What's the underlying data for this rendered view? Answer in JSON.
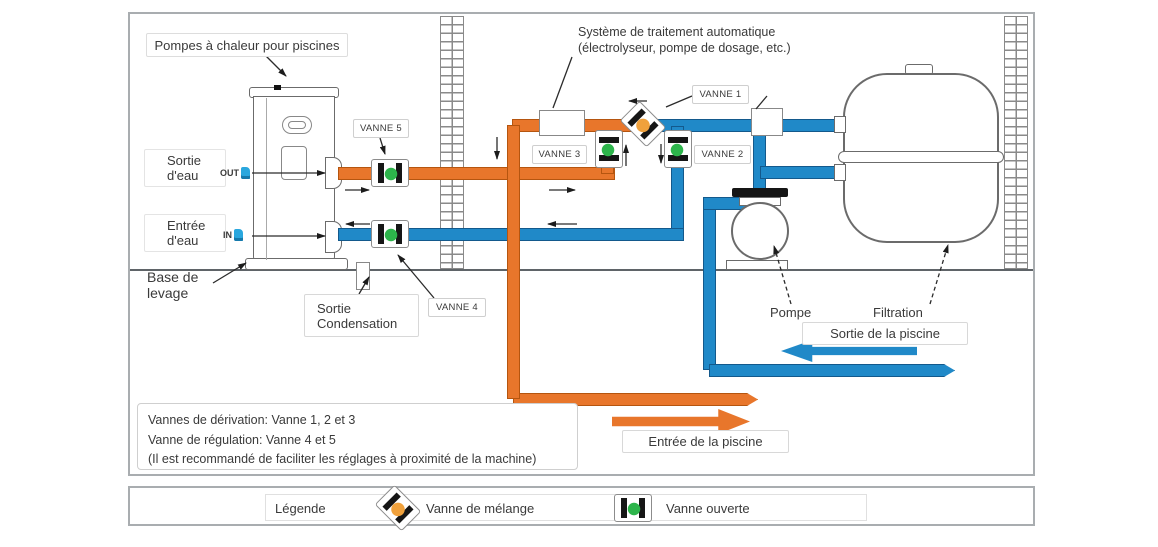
{
  "diagram": {
    "heat_pump_label": "Pompes à chaleur pour piscines",
    "treatment_system": {
      "line1": "Système de traitement automatique",
      "line2": "(électrolyseur, pompe de dosage, etc.)"
    },
    "valves": {
      "v1": "VANNE 1",
      "v2": "VANNE 2",
      "v3": "VANNE 3",
      "v4": "VANNE 4",
      "v5": "VANNE 5"
    },
    "water_outlet": {
      "line1": "Sortie",
      "line2": "d'eau",
      "port": "OUT"
    },
    "water_inlet": {
      "line1": "Entrée",
      "line2": "d'eau",
      "port": "IN"
    },
    "lifting_base": {
      "line1": "Base de",
      "line2": "levage"
    },
    "condensation": {
      "line1": "Sortie",
      "line2": "Condensation"
    },
    "pump_label": "Pompe",
    "filter_label": "Filtration",
    "pool_outlet_label": "Sortie de la piscine",
    "pool_inlet_label": "Entrée de la piscine",
    "notes": {
      "line1": "Vannes de dérivation: Vanne 1, 2 et 3",
      "line2": "Vanne de régulation: Vanne 4 et 5",
      "line3": "(Il est recommandé de faciliter les réglages à proximité de la machine)"
    }
  },
  "legend": {
    "title": "Légende",
    "mixing_valve_label": "Vanne de mélange",
    "open_valve_label": "Vanne ouverte"
  },
  "colors": {
    "hot_water_pipe": "#E8762B",
    "cold_water_pipe": "#2089C8",
    "open_valve_green": "#2DB54B",
    "mixing_valve_orange": "#F0A13C"
  }
}
